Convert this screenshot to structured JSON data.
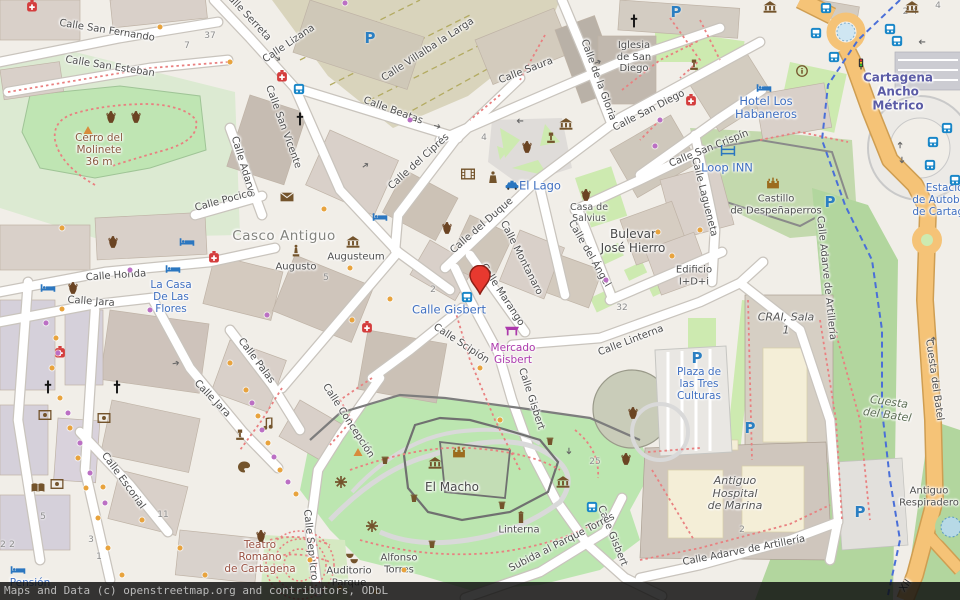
{
  "attribution": "Maps and Data (c) openstreetmap.org and contributors, ODbL",
  "marker": {
    "name": "map-marker-pin",
    "x": 480,
    "y": 299,
    "color": "#e8392f",
    "outline": "#8e1f16"
  },
  "colors": {
    "background": "#f1eee8",
    "building": "#d9d0c9",
    "building_outline": "#bfb3a6",
    "park_green": "#cdeab0",
    "bright_green": "#bfe5b3",
    "forest_green": "#b2d69e",
    "olive_zone": "#d9d4bc",
    "main_road_orange": "#f5c377",
    "road_white": "#ffffff",
    "water_blue": "#b7d9e6",
    "path_red": "#e98080",
    "cycle_route_blue": "#4a6fd8",
    "poi_orange_dot": "#e8a33d",
    "poi_purple_dot": "#bb6fc4",
    "label_street": "#4d4d4d",
    "label_blue": "#3f6fc0",
    "label_purple": "#ac39ac",
    "label_station": "#5c5ca6",
    "label_historic": "#9a5243"
  },
  "labels": [
    [
      "Calle San Fernando",
      107,
      31,
      9,
      "st"
    ],
    [
      "Calle San Esteban",
      110,
      67,
      9,
      "st"
    ],
    [
      "Calle Serreta",
      247,
      16,
      47,
      "st"
    ],
    [
      "Calle San Vicente",
      283,
      127,
      70,
      "st"
    ],
    [
      "Calle Adarve",
      243,
      167,
      73,
      "st"
    ],
    [
      "Calle Pocico",
      224,
      201,
      -15,
      "st"
    ],
    [
      "Calle Honda",
      116,
      276,
      -4,
      "st"
    ],
    [
      "Calle Jara",
      91,
      302,
      4,
      "st"
    ],
    [
      "Calle Lizana",
      289,
      44,
      -34,
      "st"
    ],
    [
      "Calle Villalba la Larga",
      428,
      50,
      -33,
      "st"
    ],
    [
      "Calle Saura",
      526,
      71,
      -21,
      "st"
    ],
    [
      "Calle Beatas",
      393,
      111,
      20,
      "st"
    ],
    [
      "Calle del Ciprés",
      419,
      162,
      -42,
      "st"
    ],
    [
      "Calle de la Gloria",
      598,
      80,
      70,
      "st"
    ],
    [
      "Calle San Diego",
      649,
      111,
      -27,
      "st"
    ],
    [
      "Calle San Crispín",
      709,
      149,
      -22,
      "st"
    ],
    [
      "Calle Lagueneta",
      704,
      197,
      76,
      "st"
    ],
    [
      "Calle del Duque",
      482,
      226,
      -41,
      "st"
    ],
    [
      "Calle Montanaro",
      521,
      258,
      63,
      "st"
    ],
    [
      "Calle Marango",
      502,
      295,
      57,
      "st"
    ],
    [
      "Calle del Ángel",
      589,
      254,
      60,
      "st"
    ],
    [
      "Calle Linterna",
      631,
      341,
      -21,
      "st"
    ],
    [
      "Calle Adarve de Artillería",
      826,
      278,
      84,
      "st"
    ],
    [
      "Cuesta del Batel",
      934,
      380,
      82,
      "st"
    ],
    [
      "Calle Gisbert",
      531,
      399,
      72,
      "st"
    ],
    [
      "Calle Gisbert",
      612,
      536,
      68,
      "st"
    ],
    [
      "Calle Scipión",
      461,
      344,
      33,
      "st"
    ],
    [
      "Calle Concepción",
      348,
      421,
      57,
      "st"
    ],
    [
      "Calle Sepulcro",
      310,
      545,
      84,
      "st"
    ],
    [
      "Calle Escorial",
      123,
      481,
      54,
      "st"
    ],
    [
      "Calle Palas",
      256,
      361,
      53,
      "st"
    ],
    [
      "Calle Jara",
      212,
      399,
      46,
      "st"
    ],
    [
      "Subida al Parque Torres",
      562,
      543,
      -27,
      "st"
    ],
    [
      "Calle Adarve de Artillería",
      744,
      551,
      -11,
      "st"
    ],
    [
      "XII",
      906,
      586,
      -55,
      "st"
    ],
    [
      "Casco Antiguo",
      284,
      237,
      0,
      "big"
    ],
    [
      "Augusto",
      296,
      267,
      0,
      "st"
    ],
    [
      "Augusteum",
      356,
      257,
      0,
      "st"
    ],
    [
      "Bulevar\nJosé Hierro",
      633,
      242,
      0,
      "nm"
    ],
    [
      "Casa de\nSalvius",
      589,
      214,
      0,
      "st9"
    ],
    [
      "Edificio\nI+D+i",
      694,
      276,
      0,
      "st"
    ],
    [
      "CRAI, Sala\n1",
      786,
      324,
      0,
      "it"
    ],
    [
      "Antiguo\nHospital\nde Marina",
      735,
      494,
      0,
      "it"
    ],
    [
      "Antiguo\nRespiradero",
      929,
      497,
      0,
      "st"
    ],
    [
      "Cuesta\ndel Batel",
      888,
      409,
      8,
      "parkit"
    ],
    [
      "El Macho",
      452,
      488,
      0,
      "nm"
    ],
    [
      "Linterna",
      519,
      530,
      0,
      "st"
    ],
    [
      "Alfonso\nTorres",
      399,
      564,
      0,
      "st"
    ],
    [
      "Auditorio\nParque",
      349,
      577,
      0,
      "st"
    ],
    [
      "Teatro\nRomano\nde Cartagena",
      260,
      557,
      0,
      "hist"
    ],
    [
      "Cerro del\nMolinete\n36 m",
      99,
      150,
      0,
      "peak"
    ],
    [
      "Iglesia\nde San\nDiego",
      634,
      57,
      0,
      "st"
    ],
    [
      "Castillo\nde Despeñaperros",
      776,
      205,
      0,
      "st"
    ],
    [
      "El Lago",
      540,
      186,
      0,
      "blue11"
    ],
    [
      "Calle Gisbert",
      449,
      310,
      0,
      "blue11"
    ],
    [
      "Hotel Los\nHabaneros",
      766,
      108,
      0,
      "blue11"
    ],
    [
      "Loop INN",
      727,
      168,
      0,
      "blue11"
    ],
    [
      "La Casa\nDe Las\nFlores",
      171,
      297,
      0,
      "blue"
    ],
    [
      "Plaza de\nlas Tres\nCulturas",
      699,
      384,
      0,
      "blue"
    ],
    [
      "Pensión",
      30,
      583,
      0,
      "blue"
    ],
    [
      "Estación\nde Autobuses\nde Cartagena",
      948,
      200,
      0,
      "blue"
    ],
    [
      "Cartagena\nAncho\nMétrico",
      898,
      92,
      0,
      "stn"
    ],
    [
      "Mercado\nGisbert",
      513,
      354,
      0,
      "mag"
    ]
  ],
  "house_numbers": [
    [
      "37",
      210,
      36
    ],
    [
      "7",
      187,
      46
    ],
    [
      "4",
      484,
      138
    ],
    [
      "2",
      433,
      290
    ],
    [
      "5",
      326,
      278
    ],
    [
      "32",
      622,
      308
    ],
    [
      "25",
      595,
      462
    ],
    [
      "11",
      163,
      515
    ],
    [
      "5",
      43,
      517
    ],
    [
      "3",
      91,
      540
    ],
    [
      "1",
      99,
      557
    ],
    [
      "2",
      3,
      545
    ],
    [
      "2",
      12,
      545
    ],
    [
      "2",
      742,
      530
    ],
    [
      "2-4",
      910,
      12
    ],
    [
      "4",
      938,
      6
    ]
  ],
  "parking": [
    [
      370,
      38
    ],
    [
      676,
      12
    ],
    [
      830,
      202
    ],
    [
      697,
      358
    ],
    [
      750,
      428
    ],
    [
      860,
      512
    ]
  ],
  "icons": [
    [
      "bus-icon",
      299,
      89
    ],
    [
      "bus-icon",
      467,
      297
    ],
    [
      "bus-icon",
      592,
      507
    ],
    [
      "bus-icon",
      826,
      8
    ],
    [
      "bus-icon",
      816,
      33
    ],
    [
      "bus-icon",
      834,
      57
    ],
    [
      "bus-icon",
      890,
      29
    ],
    [
      "bus-icon",
      897,
      41
    ],
    [
      "bus-icon",
      947,
      128
    ],
    [
      "bus-icon",
      933,
      142
    ],
    [
      "bus-icon",
      930,
      165
    ],
    [
      "bus-icon",
      955,
      180
    ],
    [
      "bed-icon",
      48,
      288
    ],
    [
      "bed-icon",
      173,
      269
    ],
    [
      "bed-icon",
      187,
      242
    ],
    [
      "bed-icon",
      380,
      217
    ],
    [
      "bed-icon",
      764,
      88
    ],
    [
      "bed-icon",
      18,
      570
    ],
    [
      "hostel-icon",
      728,
      151
    ],
    [
      "taxi-icon",
      512,
      185
    ],
    [
      "pharmacy-icon",
      32,
      6
    ],
    [
      "pharmacy-icon",
      282,
      76
    ],
    [
      "pharmacy-icon",
      691,
      100
    ],
    [
      "pharmacy-icon",
      214,
      257
    ],
    [
      "pharmacy-icon",
      60,
      352
    ],
    [
      "pharmacy-icon",
      367,
      327
    ],
    [
      "church-icon",
      300,
      120
    ],
    [
      "church-icon",
      634,
      22
    ],
    [
      "church-icon",
      48,
      388
    ],
    [
      "church-icon",
      117,
      388
    ],
    [
      "museum-icon",
      353,
      242
    ],
    [
      "museum-icon",
      566,
      124
    ],
    [
      "museum-icon",
      770,
      7
    ],
    [
      "museum-icon",
      435,
      463
    ],
    [
      "museum-icon",
      563,
      482
    ],
    [
      "museum-icon",
      912,
      7
    ],
    [
      "castle-icon",
      459,
      452
    ],
    [
      "castle-icon",
      773,
      183
    ],
    [
      "amphora-icon",
      111,
      117
    ],
    [
      "amphora-icon",
      136,
      117
    ],
    [
      "amphora-icon",
      113,
      242
    ],
    [
      "amphora-icon",
      73,
      288
    ],
    [
      "amphora-icon",
      447,
      228
    ],
    [
      "amphora-icon",
      527,
      147
    ],
    [
      "amphora-icon",
      586,
      195
    ],
    [
      "amphora-icon",
      633,
      413
    ],
    [
      "amphora-icon",
      626,
      459
    ],
    [
      "amphora-icon",
      261,
      536
    ],
    [
      "statue-icon",
      296,
      251
    ],
    [
      "monument-icon",
      88,
      130
    ],
    [
      "monument-icon",
      358,
      452
    ],
    [
      "market-icon",
      512,
      330
    ],
    [
      "theatre-masks-icon",
      352,
      558
    ],
    [
      "palette-icon",
      244,
      467
    ],
    [
      "music-note-icon",
      268,
      424
    ],
    [
      "artwork-icon",
      45,
      415
    ],
    [
      "artwork-icon",
      104,
      418
    ],
    [
      "artwork-icon",
      57,
      484
    ],
    [
      "book-icon",
      38,
      488
    ],
    [
      "lectern-icon",
      240,
      435
    ],
    [
      "lectern-icon",
      551,
      138
    ],
    [
      "lectern-icon",
      694,
      65
    ],
    [
      "envelope-icon",
      287,
      197
    ],
    [
      "cinema-icon",
      468,
      174
    ],
    [
      "police-icon",
      493,
      177
    ],
    [
      "tower-icon",
      521,
      517
    ],
    [
      "windmill-icon",
      341,
      482
    ],
    [
      "windmill-icon",
      372,
      526
    ],
    [
      "info-icon",
      802,
      71
    ],
    [
      "traffic-light-icon",
      861,
      64
    ],
    [
      "waste-icon",
      385,
      460
    ],
    [
      "waste-icon",
      414,
      498
    ],
    [
      "waste-icon",
      502,
      505
    ],
    [
      "waste-icon",
      550,
      441
    ],
    [
      "waste-icon",
      432,
      544
    ]
  ],
  "arrows": [
    [
      277,
      59,
      35
    ],
    [
      437,
      127,
      15
    ],
    [
      598,
      63,
      -20
    ],
    [
      520,
      120,
      180
    ],
    [
      366,
      166,
      -35
    ],
    [
      176,
      364,
      -10
    ],
    [
      568,
      451,
      90
    ],
    [
      922,
      41,
      180
    ],
    [
      901,
      145,
      -90
    ],
    [
      901,
      160,
      90
    ],
    [
      934,
      340,
      -80
    ]
  ],
  "dots": [
    [
      "o",
      160,
      27
    ],
    [
      "p",
      345,
      3
    ],
    [
      "o",
      230,
      62
    ],
    [
      "p",
      410,
      120
    ],
    [
      "p",
      660,
      120
    ],
    [
      "p",
      655,
      146
    ],
    [
      "o",
      62,
      228
    ],
    [
      "o",
      324,
      209
    ],
    [
      "p",
      130,
      270
    ],
    [
      "o",
      350,
      268
    ],
    [
      "p",
      267,
      315
    ],
    [
      "o",
      390,
      299
    ],
    [
      "o",
      352,
      320
    ],
    [
      "p",
      150,
      310
    ],
    [
      "o",
      62,
      309
    ],
    [
      "p",
      46,
      323
    ],
    [
      "o",
      56,
      338
    ],
    [
      "p",
      58,
      353
    ],
    [
      "o",
      52,
      368
    ],
    [
      "p",
      68,
      413
    ],
    [
      "o",
      60,
      398
    ],
    [
      "o",
      70,
      428
    ],
    [
      "p",
      80,
      443
    ],
    [
      "o",
      78,
      458
    ],
    [
      "p",
      90,
      473
    ],
    [
      "o",
      86,
      488
    ],
    [
      "p",
      105,
      503
    ],
    [
      "o",
      98,
      518
    ],
    [
      "o",
      108,
      548
    ],
    [
      "o",
      122,
      575
    ],
    [
      "o",
      230,
      363
    ],
    [
      "p",
      252,
      403
    ],
    [
      "o",
      246,
      390
    ],
    [
      "o",
      258,
      416
    ],
    [
      "p",
      262,
      430
    ],
    [
      "o",
      268,
      443
    ],
    [
      "p",
      274,
      457
    ],
    [
      "o",
      280,
      470
    ],
    [
      "p",
      288,
      482
    ],
    [
      "o",
      296,
      494
    ],
    [
      "o",
      310,
      560
    ],
    [
      "o",
      340,
      588
    ],
    [
      "o",
      376,
      592
    ],
    [
      "o",
      404,
      570
    ],
    [
      "o",
      480,
      368
    ],
    [
      "o",
      500,
      420
    ],
    [
      "o",
      658,
      232
    ],
    [
      "o",
      672,
      256
    ],
    [
      "o",
      700,
      230
    ],
    [
      "o",
      103,
      487
    ],
    [
      "o",
      142,
      520
    ],
    [
      "o",
      180,
      548
    ],
    [
      "o",
      205,
      575
    ],
    [
      "p",
      606,
      280
    ]
  ]
}
